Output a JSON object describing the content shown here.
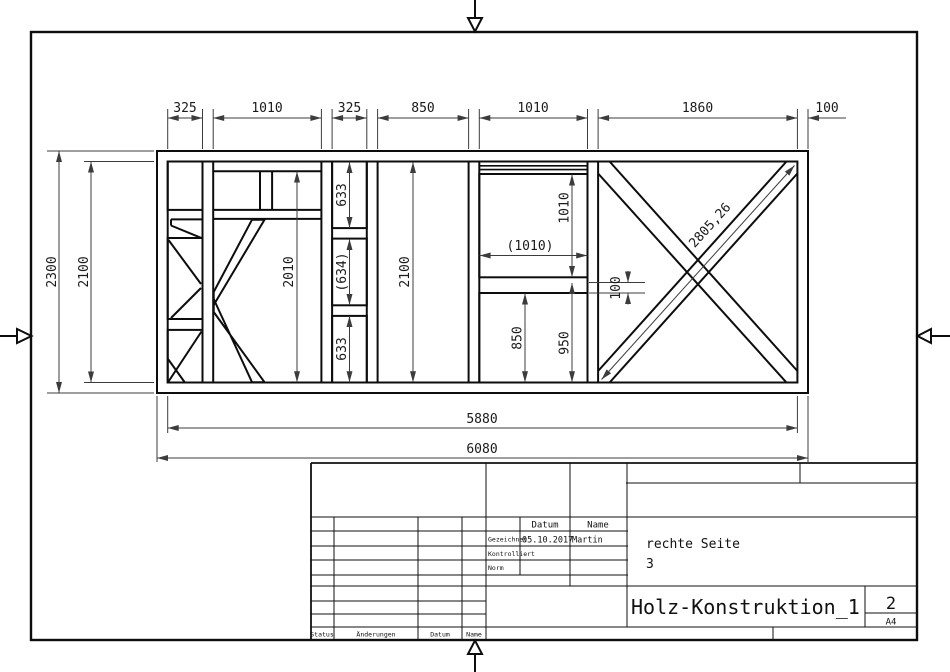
{
  "colors": {
    "line": "#0d0d0d",
    "dim_line": "#3c3c3c",
    "paper": "#ffffff"
  },
  "dims": {
    "top": [
      "325",
      "1010",
      "325",
      "850",
      "1010",
      "1860",
      "100"
    ],
    "left_outer": "2300",
    "left_inner": "2100",
    "p2_height": "2010",
    "p3": [
      "633",
      "(634)",
      "633"
    ],
    "p4_height": "2100",
    "p5_top": "1010",
    "p5_width": "(1010)",
    "p5_member": "100",
    "p5_lower": "850",
    "p5_lower_total": "950",
    "p6_diagonal": "2805,26",
    "bottom_inner": "5880",
    "bottom_outer": "6080"
  },
  "title_block": {
    "header_datum": "Datum",
    "header_name": "Name",
    "row_drawn_label": "Gezeichnet",
    "row_drawn_date": "05.10.2017",
    "row_drawn_name": "Martin",
    "row_checked_label": "Kontrolliert",
    "row_norm_label": "Norm",
    "part_name": "rechte Seite",
    "part_number": "3",
    "doc_title": "Holz-Konstruktion_1",
    "sheet_number": "2",
    "paper_size": "A4",
    "rev_status": "Status",
    "rev_changes": "Änderungen",
    "rev_datum": "Datum",
    "rev_name": "Name"
  }
}
